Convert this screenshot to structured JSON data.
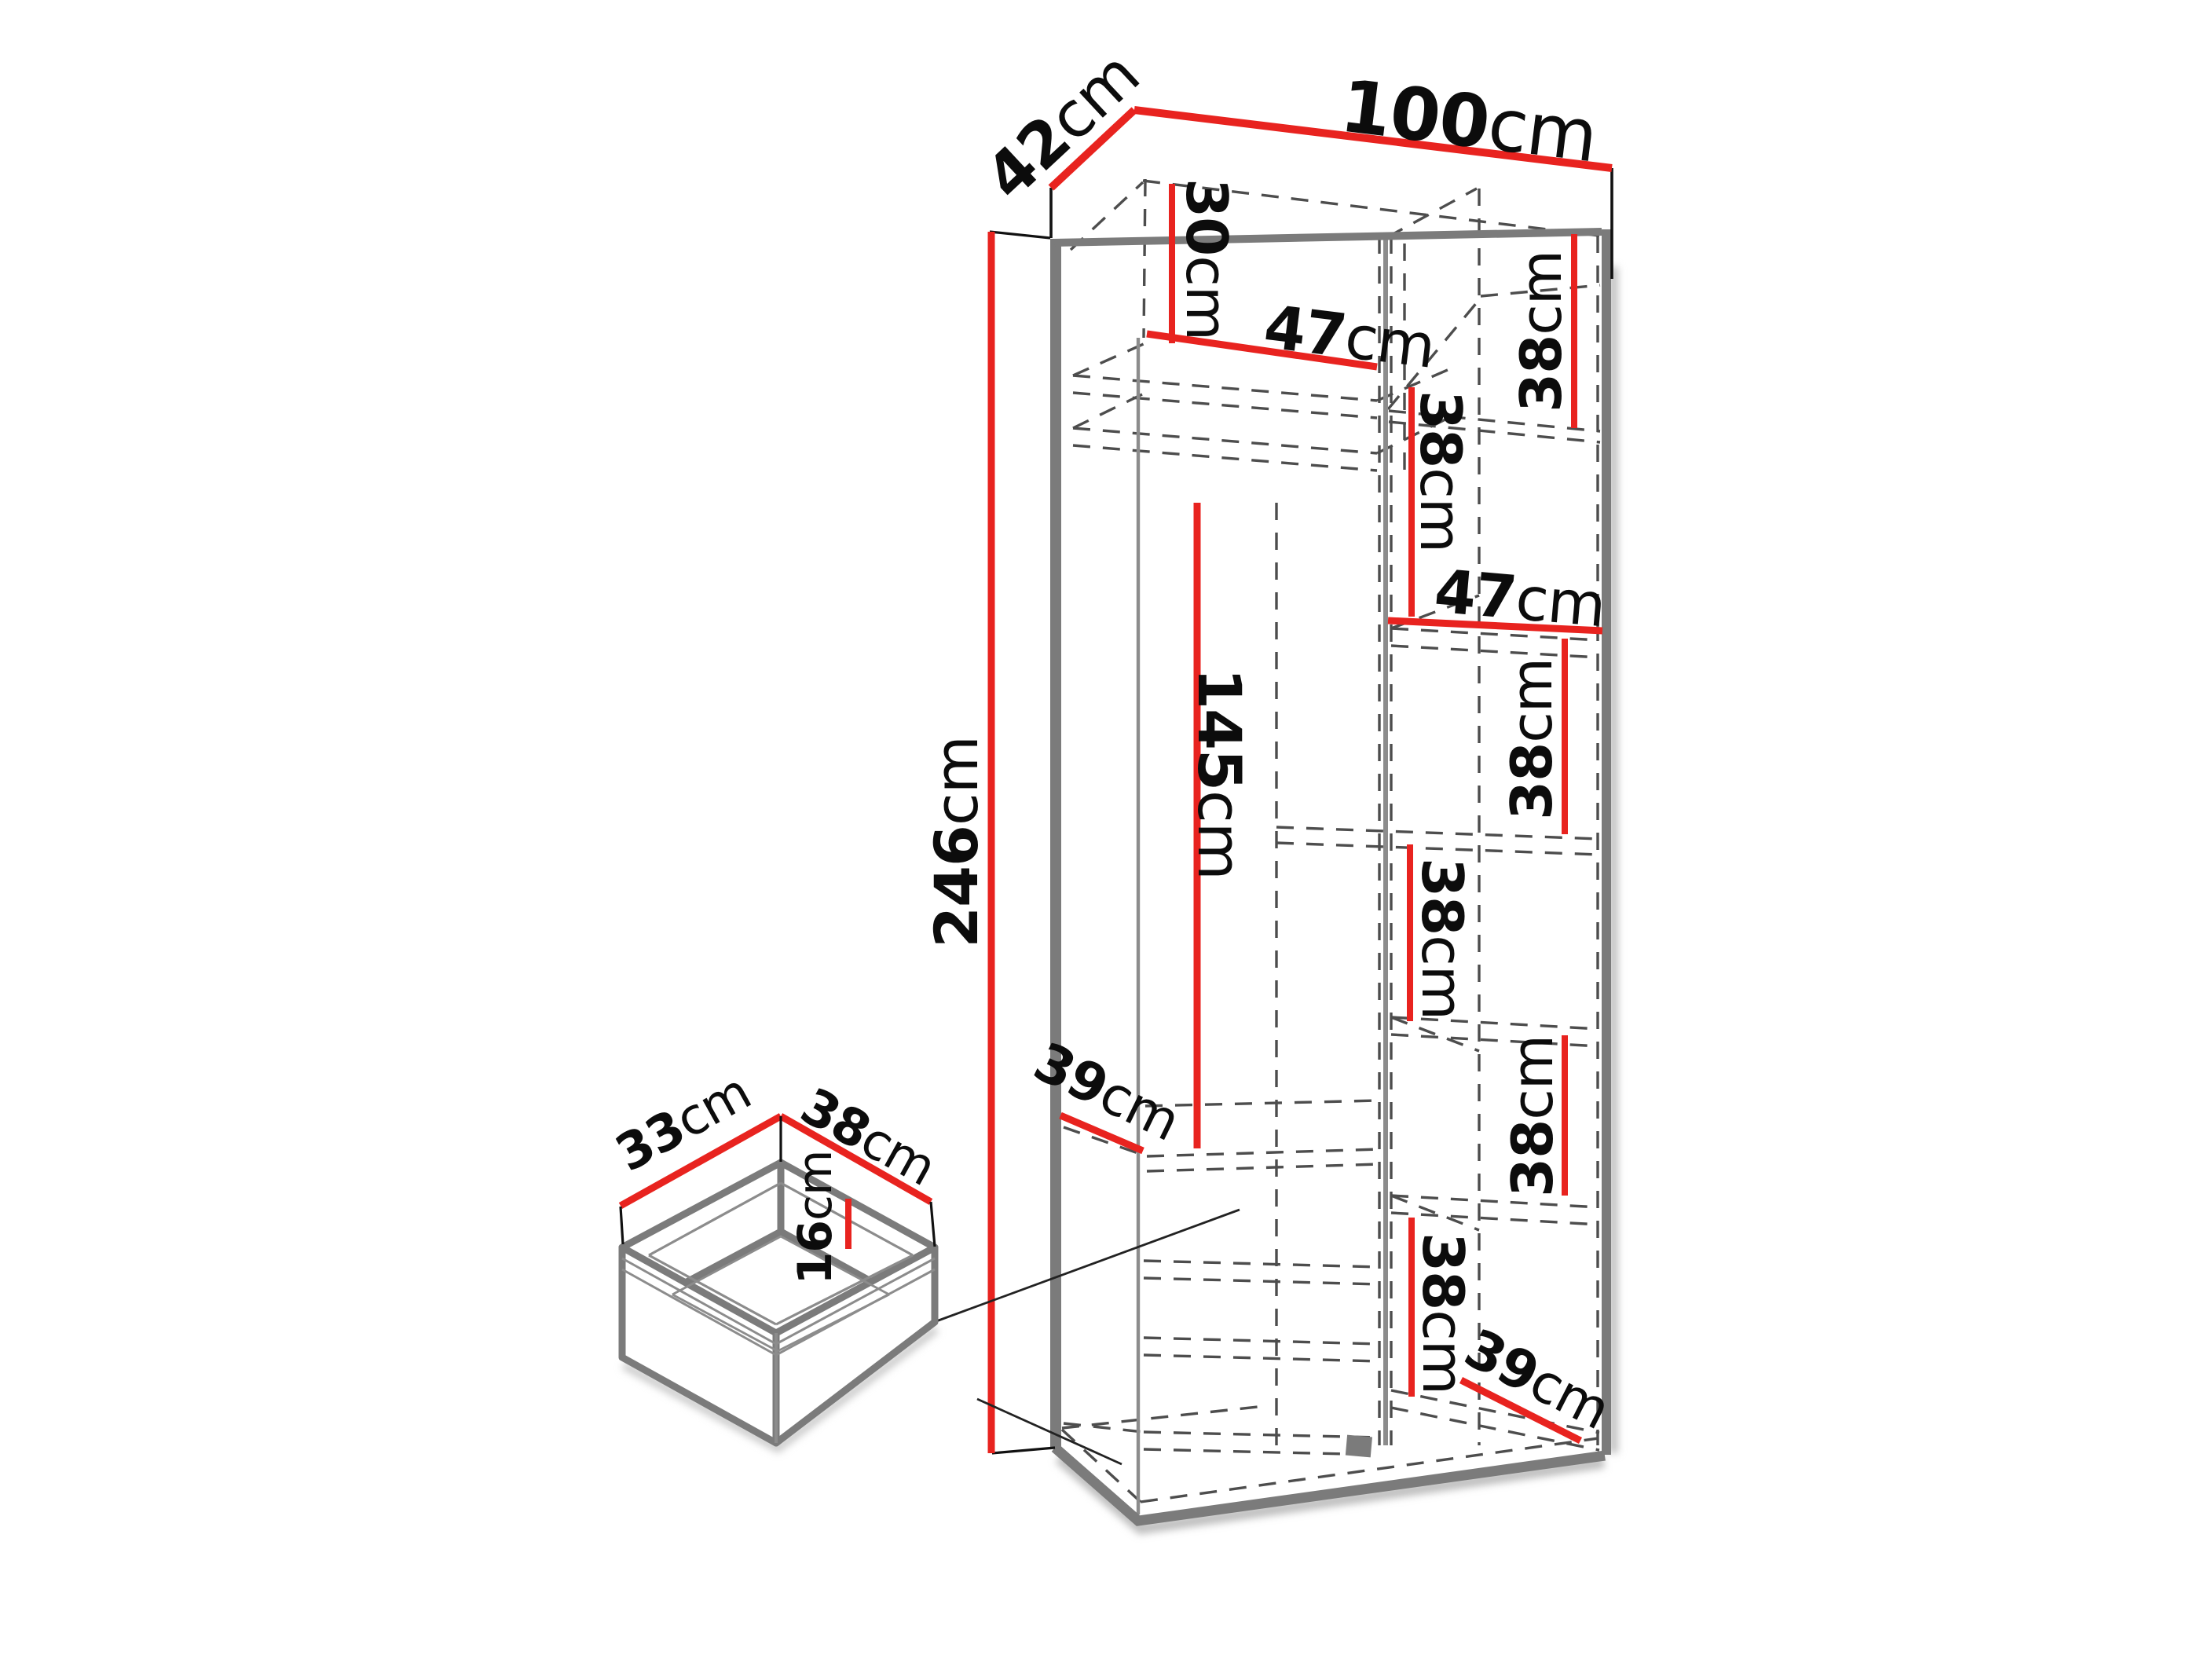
{
  "colors": {
    "dimension_red": "#e8231f",
    "edge_gray": "#7b7b7b",
    "dash_gray": "#4d4d4d",
    "text_black": "#0c0c0c",
    "background": "#ffffff"
  },
  "wardrobe": {
    "overall": {
      "width": {
        "value": "100",
        "unit": "cm"
      },
      "depth": {
        "value": "42",
        "unit": "cm"
      },
      "height": {
        "value": "246",
        "unit": "cm"
      }
    },
    "interior": {
      "top_compartment_height": {
        "value": "30",
        "unit": "cm"
      },
      "left_section_width": {
        "value": "47",
        "unit": "cm"
      },
      "hanging_space_height": {
        "value": "145",
        "unit": "cm"
      },
      "left_shelf_depth": {
        "value": "39",
        "unit": "cm"
      },
      "right_section_width": {
        "value": "47",
        "unit": "cm"
      },
      "shelf_heights": [
        {
          "value": "38",
          "unit": "cm"
        },
        {
          "value": "38",
          "unit": "cm"
        },
        {
          "value": "38",
          "unit": "cm"
        },
        {
          "value": "38",
          "unit": "cm"
        },
        {
          "value": "38",
          "unit": "cm"
        },
        {
          "value": "38",
          "unit": "cm"
        }
      ],
      "bottom_shelf_depth": {
        "value": "39",
        "unit": "cm"
      }
    }
  },
  "drawer_detail": {
    "depth": {
      "value": "33",
      "unit": "cm"
    },
    "width": {
      "value": "38",
      "unit": "cm"
    },
    "height": {
      "value": "16",
      "unit": "cm"
    }
  }
}
